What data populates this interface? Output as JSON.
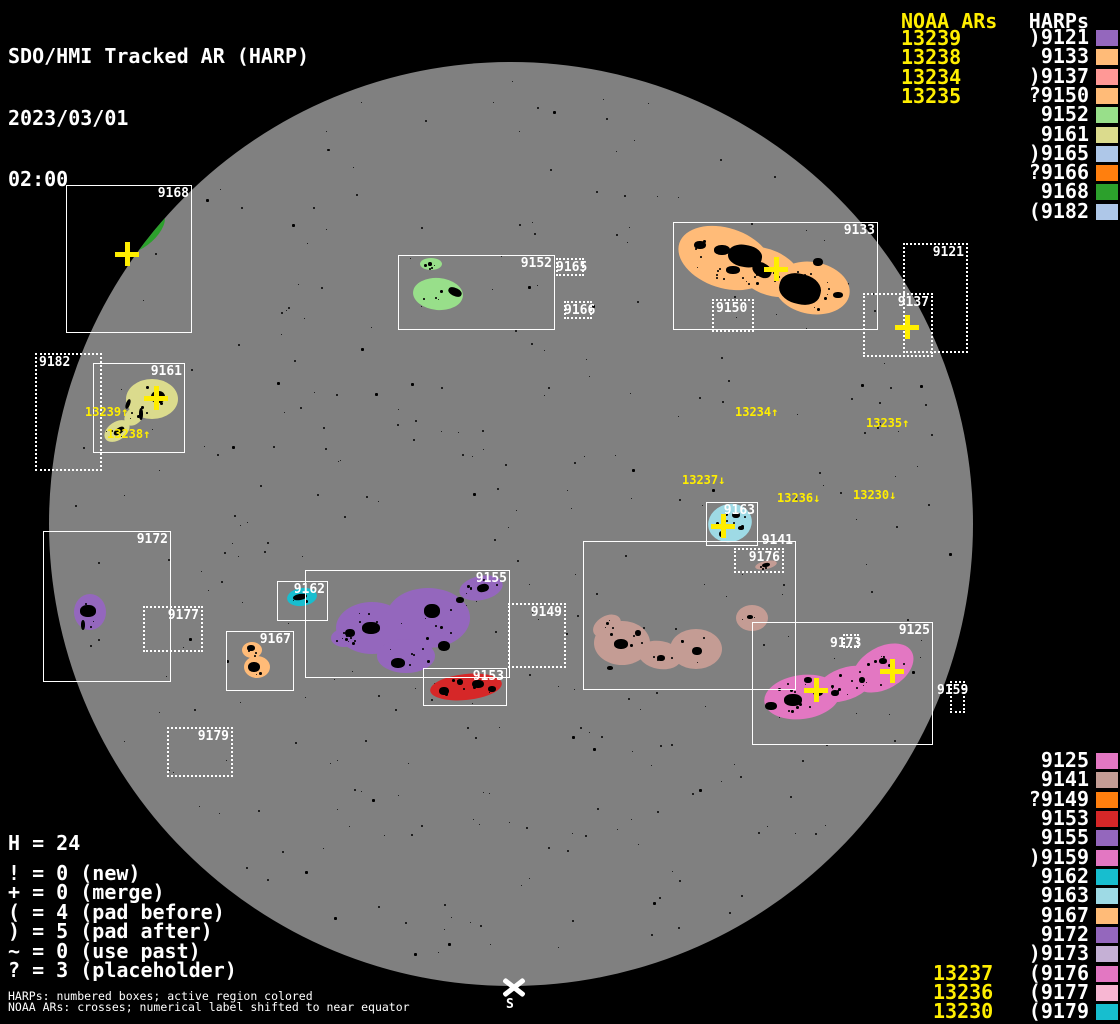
{
  "title": {
    "app": "SDO/HMI Tracked AR (HARP)",
    "date": "2023/03/01",
    "time": "02:00"
  },
  "colors": {
    "background": "#000000",
    "disk": "#808080",
    "box_border": "#ffffff",
    "text": "#ffffff",
    "noaa_yellow": "#ffee00"
  },
  "panel_top_right": {
    "noaa_header": "NOAA ARs",
    "harps_header": "HARPs",
    "noaa_items": [
      "13239",
      "13238",
      "13234",
      "13235"
    ],
    "harp_items": [
      {
        "label": ")9121",
        "color": "#9467bd"
      },
      {
        "label": "9133",
        "color": "#ffbb78"
      },
      {
        "label": ")9137",
        "color": "#ff9896"
      },
      {
        "label": "?9150",
        "color": "#ffbb78"
      },
      {
        "label": "9152",
        "color": "#98df8a"
      },
      {
        "label": "9161",
        "color": "#dbdb8d"
      },
      {
        "label": ")9165",
        "color": "#aec7e8"
      },
      {
        "label": "?9166",
        "color": "#ff7f0e"
      },
      {
        "label": "9168",
        "color": "#2ca02c"
      },
      {
        "label": "(9182",
        "color": "#aec7e8"
      }
    ]
  },
  "panel_bottom_right": {
    "noaa_items": [
      "13237",
      "13236",
      "13230"
    ],
    "harp_items": [
      {
        "label": "9125",
        "color": "#e377c2"
      },
      {
        "label": "9141",
        "color": "#c49c94"
      },
      {
        "label": "?9149",
        "color": "#ff7f0e"
      },
      {
        "label": "9153",
        "color": "#d62728"
      },
      {
        "label": "9155",
        "color": "#9467bd"
      },
      {
        "label": ")9159",
        "color": "#e377c2"
      },
      {
        "label": "9162",
        "color": "#17becf"
      },
      {
        "label": "9163",
        "color": "#9edae5"
      },
      {
        "label": "9167",
        "color": "#ffbb78"
      },
      {
        "label": "9172",
        "color": "#9467bd"
      },
      {
        "label": ")9173",
        "color": "#c5b0d5"
      },
      {
        "label": "(9176",
        "color": "#e377c2"
      },
      {
        "label": "(9177",
        "color": "#f7b6d2"
      },
      {
        "label": "(9179",
        "color": "#17becf"
      }
    ]
  },
  "legend": {
    "harp_count": "H = 24",
    "lines": [
      "! = 0 (new)",
      "+ = 0 (merge)",
      "( = 4 (pad before)",
      ") = 5 (pad after)",
      "~ = 0 (use past)",
      "? = 3 (placeholder)"
    ]
  },
  "footnotes": [
    "HARPs: numbered boxes; active region colored",
    "NOAA ARs: crosses; numerical label shifted to near equator"
  ],
  "south_label": "S",
  "disk": {
    "cx": 511,
    "cy": 524,
    "r": 462
  },
  "harp_boxes": [
    {
      "id": "9168",
      "x": 66,
      "y": 185,
      "w": 126,
      "h": 148,
      "style": "solid",
      "labelPos": "tr"
    },
    {
      "id": "9182",
      "x": 35,
      "y": 353,
      "w": 67,
      "h": 118,
      "style": "dotted",
      "labelPos": "tl"
    },
    {
      "id": "9161",
      "x": 93,
      "y": 363,
      "w": 92,
      "h": 90,
      "style": "solid",
      "labelPos": "tr"
    },
    {
      "id": "9152",
      "x": 398,
      "y": 255,
      "w": 157,
      "h": 75,
      "style": "solid",
      "labelPos": "tr"
    },
    {
      "id": "9165",
      "x": 556,
      "y": 258,
      "w": 28,
      "h": 18,
      "style": "dotted",
      "labelPos": "in"
    },
    {
      "id": "9166",
      "x": 564,
      "y": 301,
      "w": 28,
      "h": 18,
      "style": "dotted",
      "labelPos": "in"
    },
    {
      "id": "9133",
      "x": 673,
      "y": 222,
      "w": 205,
      "h": 108,
      "style": "solid",
      "labelPos": "tr"
    },
    {
      "id": "9150",
      "x": 712,
      "y": 299,
      "w": 42,
      "h": 33,
      "style": "dotted",
      "labelPos": "tl"
    },
    {
      "id": "9121",
      "x": 903,
      "y": 243,
      "w": 65,
      "h": 110,
      "style": "dotted",
      "labelPos": "tr"
    },
    {
      "id": "9137",
      "x": 863,
      "y": 293,
      "w": 70,
      "h": 64,
      "style": "dotted",
      "labelPos": "tr"
    },
    {
      "id": "9172",
      "x": 43,
      "y": 531,
      "w": 128,
      "h": 151,
      "style": "solid",
      "labelPos": "tr"
    },
    {
      "id": "9177",
      "x": 143,
      "y": 606,
      "w": 60,
      "h": 46,
      "style": "dotted",
      "labelPos": "tr"
    },
    {
      "id": "9162",
      "x": 277,
      "y": 581,
      "w": 51,
      "h": 40,
      "style": "solid",
      "labelPos": "tr"
    },
    {
      "id": "9155",
      "x": 305,
      "y": 570,
      "w": 205,
      "h": 108,
      "style": "solid",
      "labelPos": "tr"
    },
    {
      "id": "9149",
      "x": 508,
      "y": 603,
      "w": 58,
      "h": 65,
      "style": "dotted",
      "labelPos": "tr"
    },
    {
      "id": "9167",
      "x": 226,
      "y": 631,
      "w": 68,
      "h": 60,
      "style": "solid",
      "labelPos": "tr"
    },
    {
      "id": "9153",
      "x": 423,
      "y": 668,
      "w": 84,
      "h": 38,
      "style": "solid",
      "labelPos": "tr"
    },
    {
      "id": "9179",
      "x": 167,
      "y": 727,
      "w": 66,
      "h": 50,
      "style": "dotted",
      "labelPos": "tr"
    },
    {
      "id": "9163",
      "x": 706,
      "y": 502,
      "w": 52,
      "h": 44,
      "style": "solid",
      "labelPos": "tr"
    },
    {
      "id": "9141",
      "x": 583,
      "y": 541,
      "w": 213,
      "h": 149,
      "style": "solid",
      "labelPos": "tr",
      "labelDy": -8
    },
    {
      "id": "9176",
      "x": 734,
      "y": 548,
      "w": 50,
      "h": 25,
      "style": "dotted",
      "labelPos": "tr"
    },
    {
      "id": "9125",
      "x": 752,
      "y": 622,
      "w": 181,
      "h": 123,
      "style": "solid",
      "labelPos": "tr"
    },
    {
      "id": "9173",
      "x": 843,
      "y": 634,
      "w": 16,
      "h": 14,
      "style": "dotted",
      "labelPos": "left"
    },
    {
      "id": "9159",
      "x": 950,
      "y": 681,
      "w": 15,
      "h": 32,
      "style": "dotted",
      "labelPos": "left"
    }
  ],
  "regions": [
    {
      "harp": "9168",
      "color": "#2ca02c",
      "ellipses": [
        [
          143,
          232,
          27,
          13,
          -42
        ],
        [
          99,
          277,
          23,
          8,
          -64
        ]
      ],
      "spots": [
        [
          140,
          233,
          12,
          3,
          -42
        ],
        [
          97,
          280,
          8,
          2,
          -64
        ]
      ],
      "speckles": 10
    },
    {
      "harp": "9161",
      "color": "#dbdb8d",
      "ellipses": [
        [
          152,
          399,
          26,
          20,
          0
        ],
        [
          117,
          431,
          14,
          9,
          -35
        ],
        [
          134,
          416,
          11,
          8,
          -45
        ]
      ],
      "spots": [
        [
          158,
          397,
          7,
          6,
          0
        ],
        [
          141,
          414,
          2,
          6,
          0
        ],
        [
          119,
          431,
          6,
          3,
          -35
        ],
        [
          128,
          404,
          2,
          5,
          20
        ]
      ],
      "speckles": 10
    },
    {
      "harp": "9152",
      "color": "#98df8a",
      "ellipses": [
        [
          431,
          264,
          11,
          6,
          0
        ],
        [
          438,
          294,
          25,
          16,
          5
        ]
      ],
      "spots": [
        [
          455,
          292,
          7,
          4,
          25
        ],
        [
          430,
          264,
          2,
          2,
          0
        ]
      ],
      "speckles": 8
    },
    {
      "harp": "9133",
      "color": "#ffbb78",
      "ellipses": [
        [
          725,
          258,
          48,
          30,
          18
        ],
        [
          768,
          272,
          36,
          22,
          25
        ],
        [
          812,
          288,
          38,
          26,
          10
        ]
      ],
      "spots": [
        [
          800,
          289,
          21,
          15,
          15
        ],
        [
          745,
          256,
          17,
          11,
          10
        ],
        [
          762,
          270,
          10,
          7,
          30
        ],
        [
          722,
          250,
          8,
          5,
          0
        ],
        [
          700,
          245,
          6,
          4,
          0
        ],
        [
          733,
          270,
          7,
          4,
          0
        ],
        [
          818,
          262,
          5,
          4,
          0
        ],
        [
          838,
          295,
          5,
          3,
          0
        ]
      ],
      "speckles": 45
    },
    {
      "harp": "9163",
      "color": "#9edae5",
      "ellipses": [
        [
          730,
          523,
          22,
          19,
          -15
        ]
      ],
      "spots": [
        [
          736,
          515,
          4,
          3,
          0
        ],
        [
          722,
          534,
          3,
          3,
          0
        ],
        [
          741,
          528,
          3,
          2,
          0
        ]
      ],
      "speckles": 6
    },
    {
      "harp": "9162",
      "color": "#17becf",
      "ellipses": [
        [
          302,
          597,
          15,
          9,
          -8
        ]
      ],
      "spots": [
        [
          300,
          597,
          7,
          3,
          -10
        ]
      ],
      "speckles": 4
    },
    {
      "harp": "9172",
      "color": "#9467bd",
      "ellipses": [
        [
          90,
          612,
          16,
          18,
          0
        ]
      ],
      "spots": [
        [
          88,
          611,
          8,
          6,
          0
        ],
        [
          83,
          625,
          2,
          5,
          0
        ]
      ],
      "speckles": 5
    },
    {
      "harp": "9155",
      "color": "#9467bd",
      "ellipses": [
        [
          372,
          628,
          36,
          26,
          0
        ],
        [
          428,
          618,
          42,
          30,
          0
        ],
        [
          406,
          656,
          29,
          17,
          0
        ],
        [
          344,
          638,
          13,
          9,
          0
        ],
        [
          481,
          588,
          22,
          12,
          -12
        ]
      ],
      "spots": [
        [
          371,
          628,
          9,
          6,
          0
        ],
        [
          432,
          611,
          8,
          7,
          0
        ],
        [
          444,
          646,
          6,
          5,
          0
        ],
        [
          398,
          663,
          7,
          5,
          0
        ],
        [
          483,
          588,
          6,
          4,
          -12
        ],
        [
          350,
          633,
          5,
          4,
          0
        ],
        [
          460,
          600,
          4,
          3,
          0
        ]
      ],
      "speckles": 35
    },
    {
      "harp": "9167",
      "color": "#ffbb78",
      "ellipses": [
        [
          252,
          650,
          10,
          8,
          0
        ],
        [
          257,
          667,
          13,
          11,
          0
        ]
      ],
      "spots": [
        [
          251,
          648,
          4,
          3,
          0
        ],
        [
          254,
          667,
          6,
          5,
          0
        ]
      ],
      "speckles": 5
    },
    {
      "harp": "9153",
      "color": "#d62728",
      "ellipses": [
        [
          466,
          687,
          36,
          13,
          -6
        ]
      ],
      "spots": [
        [
          444,
          691,
          5,
          4,
          0
        ],
        [
          478,
          684,
          6,
          4,
          0
        ],
        [
          492,
          689,
          4,
          3,
          0
        ],
        [
          460,
          682,
          3,
          3,
          0
        ]
      ],
      "speckles": 8
    },
    {
      "harp": "9141",
      "color": "#c49c94",
      "ellipses": [
        [
          622,
          643,
          28,
          22,
          0
        ],
        [
          660,
          655,
          22,
          14,
          10
        ],
        [
          696,
          649,
          26,
          20,
          0
        ],
        [
          607,
          626,
          15,
          10,
          -30
        ],
        [
          752,
          618,
          16,
          13,
          0
        ],
        [
          766,
          565,
          11,
          4,
          -12
        ]
      ],
      "spots": [
        [
          621,
          644,
          7,
          5,
          0
        ],
        [
          697,
          651,
          5,
          4,
          0
        ],
        [
          661,
          658,
          4,
          3,
          0
        ],
        [
          638,
          633,
          3,
          3,
          0
        ],
        [
          750,
          617,
          3,
          2,
          0
        ],
        [
          766,
          565,
          4,
          2,
          -12
        ],
        [
          610,
          668,
          3,
          2,
          0
        ]
      ],
      "speckles": 22
    },
    {
      "harp": "9125",
      "color": "#e377c2",
      "ellipses": [
        [
          802,
          697,
          38,
          22,
          -8
        ],
        [
          845,
          684,
          30,
          16,
          -20
        ],
        [
          883,
          668,
          33,
          21,
          -30
        ]
      ],
      "spots": [
        [
          793,
          700,
          9,
          6,
          0
        ],
        [
          771,
          706,
          6,
          4,
          0
        ],
        [
          818,
          692,
          5,
          4,
          0
        ],
        [
          883,
          661,
          4,
          3,
          0
        ],
        [
          808,
          680,
          4,
          3,
          0
        ],
        [
          835,
          693,
          4,
          3,
          0
        ],
        [
          862,
          680,
          3,
          3,
          0
        ]
      ],
      "speckles": 30
    }
  ],
  "noaa_crosses": [
    [
      127,
      254
    ],
    [
      156,
      398
    ],
    [
      776,
      269
    ],
    [
      907,
      327
    ],
    [
      723,
      526
    ],
    [
      816,
      690
    ],
    [
      892,
      671
    ]
  ],
  "noaa_disk_labels": [
    {
      "text": "13239↑",
      "x": 85,
      "y": 406
    },
    {
      "text": "13238↑",
      "x": 107,
      "y": 428
    },
    {
      "text": "13234↑",
      "x": 735,
      "y": 406
    },
    {
      "text": "13235↑",
      "x": 866,
      "y": 417
    },
    {
      "text": "13237↓",
      "x": 682,
      "y": 474
    },
    {
      "text": "13236↓",
      "x": 777,
      "y": 492
    },
    {
      "text": "13230↓",
      "x": 853,
      "y": 489
    }
  ]
}
